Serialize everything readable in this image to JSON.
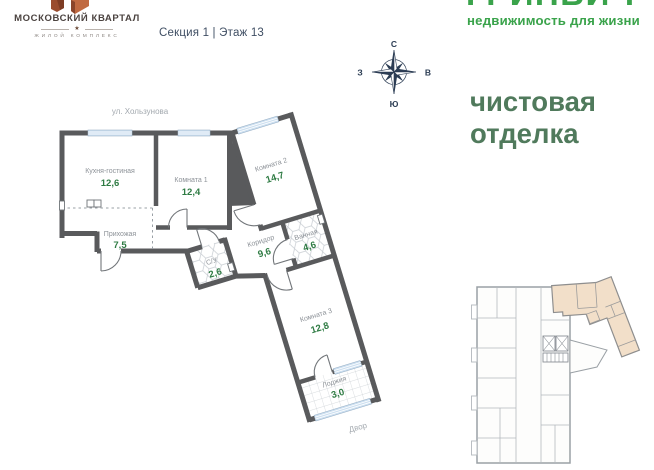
{
  "header": {
    "logo": {
      "title": "МОСКОВСКИЙ КВАРТАЛ",
      "star": "★",
      "subtitle": "ЖИЛОЙ КОМПЛЕКС"
    },
    "section_floor": "Секция 1 | Этаж 13",
    "brand": {
      "name": "ГРИНВИЧ",
      "tagline": "недвижимость для жизни"
    }
  },
  "finish": {
    "line1": "чистовая",
    "line2": "отделка"
  },
  "compass": {
    "north": "С",
    "east": "В",
    "south": "Ю",
    "west": "З"
  },
  "plan": {
    "street_label": "ул. Хользунова",
    "yard_label": "Двор",
    "rooms": [
      {
        "name": "Кухня-гостиная",
        "area": "12,6"
      },
      {
        "name": "Комната 1",
        "area": "12,4"
      },
      {
        "name": "Прихожая",
        "area": "7,5"
      },
      {
        "name": "Комната 2",
        "area": "14,7"
      },
      {
        "name": "Коридор",
        "area": "9,6"
      },
      {
        "name": "Ванная",
        "area": "4,6"
      },
      {
        "name": "С/У",
        "area": "2,6"
      },
      {
        "name": "Комната 3",
        "area": "12,8"
      },
      {
        "name": "Лоджия",
        "area": "3,0"
      }
    ]
  },
  "colors": {
    "wall": "#595a5c",
    "accent_green": "#3aa34b",
    "finish_green": "#507a5c",
    "area_green": "#2e7b43",
    "window_blue": "#ccdff0",
    "highlight_tan": "#f2dfc9",
    "logo_rust_dark": "#9a4c2e",
    "logo_rust_light": "#c06a42"
  }
}
